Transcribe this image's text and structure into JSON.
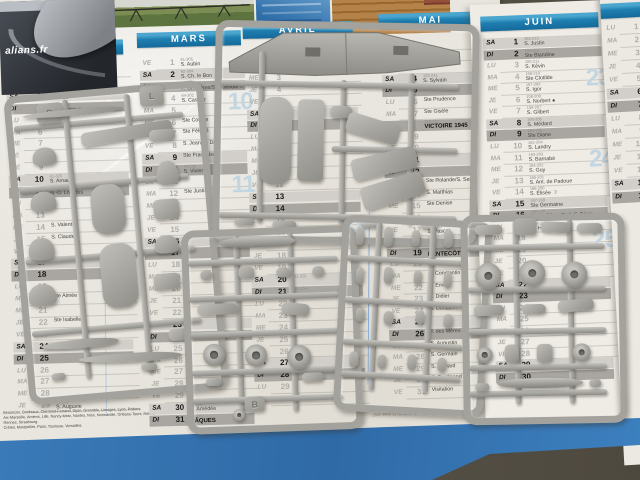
{
  "magazine": {
    "text": "alians.fr"
  },
  "calendar": {
    "day_abbrevs": [
      "LU",
      "MA",
      "ME",
      "JE",
      "VE",
      "SA",
      "DI"
    ],
    "months": [
      {
        "name": "FÉVRIER",
        "start": 3,
        "weeks": [],
        "rows": [
          [
            1,
            "32-334",
            "Ste Ella"
          ],
          [
            2,
            "33-333",
            "Présentation ☾"
          ],
          [
            3,
            "34-332",
            "S. Blaise"
          ],
          [
            4,
            "35-331",
            "Ste Véronique"
          ],
          [
            5,
            "",
            ""
          ],
          [
            6,
            "",
            ""
          ],
          [
            7,
            "",
            ""
          ],
          [
            8,
            "",
            ""
          ],
          [
            9,
            "",
            ""
          ],
          [
            10,
            "41-325",
            "S. Arnaud"
          ],
          [
            11,
            "42-324",
            "N.-D. Lourdes"
          ],
          [
            12,
            "",
            ""
          ],
          [
            13,
            "",
            ""
          ],
          [
            14,
            "",
            "S. Valentin"
          ],
          [
            15,
            "",
            "S. Claude"
          ],
          [
            16,
            "",
            ""
          ],
          [
            17,
            "",
            ""
          ],
          [
            18,
            "",
            ""
          ],
          [
            19,
            "",
            ""
          ],
          [
            20,
            "",
            "Ste Aimée"
          ],
          [
            21,
            "",
            ""
          ],
          [
            22,
            "",
            "Ste Isabelle"
          ],
          [
            23,
            "",
            ""
          ],
          [
            24,
            "",
            ""
          ],
          [
            25,
            "",
            ""
          ],
          [
            26,
            "",
            ""
          ],
          [
            27,
            "",
            ""
          ],
          [
            28,
            "",
            ""
          ],
          [
            29,
            "60-306",
            "S. Auguste"
          ]
        ]
      },
      {
        "name": "MARS",
        "start": 4,
        "weeks": [
          {
            "n": "10",
            "at": 4
          },
          {
            "n": "11",
            "at": 11
          }
        ],
        "rows": [
          [
            1,
            "61-305",
            "S. Aubin"
          ],
          [
            2,
            "62-304",
            "S. Ch. le Bon"
          ],
          [
            3,
            "63-303",
            "F. Gr.-Mères/S. Guénolé ☾"
          ],
          [
            4,
            "64-302",
            "S. Casimir"
          ],
          [
            5,
            "",
            ""
          ],
          [
            6,
            "",
            "Ste Colette"
          ],
          [
            7,
            "",
            "Ste Félicité"
          ],
          [
            8,
            "",
            "S. Jean de Dieu"
          ],
          [
            9,
            "",
            "Ste Françoise"
          ],
          [
            10,
            "70-296",
            "S. Vivien"
          ],
          [
            11,
            "",
            ""
          ],
          [
            12,
            "",
            "Ste Justine"
          ],
          [
            13,
            "",
            ""
          ],
          [
            14,
            "",
            ""
          ],
          [
            15,
            "",
            ""
          ],
          [
            16,
            "",
            ""
          ],
          [
            17,
            "",
            ""
          ],
          [
            18,
            "",
            ""
          ],
          [
            19,
            "",
            ""
          ],
          [
            20,
            "",
            ""
          ],
          [
            21,
            "",
            ""
          ],
          [
            22,
            "",
            ""
          ],
          [
            23,
            "",
            ""
          ],
          [
            24,
            "",
            ""
          ],
          [
            25,
            "",
            ""
          ],
          [
            26,
            "",
            ""
          ],
          [
            27,
            "",
            ""
          ],
          [
            28,
            "",
            ""
          ],
          [
            29,
            "",
            ""
          ],
          [
            30,
            "90-276",
            "S. Amédée"
          ],
          [
            31,
            "91-275",
            "PÂQUES",
            "h"
          ]
        ]
      },
      {
        "name": "AVRIL",
        "start": 0,
        "weeks": [
          {
            "n": "16",
            "at": 15
          }
        ],
        "rows": [
          [
            1,
            "",
            ""
          ],
          [
            2,
            "",
            ""
          ],
          [
            3,
            "",
            ""
          ],
          [
            4,
            "",
            ""
          ],
          [
            5,
            "",
            ""
          ],
          [
            6,
            "",
            ""
          ],
          [
            7,
            "",
            ""
          ],
          [
            8,
            "",
            ""
          ],
          [
            9,
            "",
            ""
          ],
          [
            10,
            "",
            ""
          ],
          [
            11,
            "",
            ""
          ],
          [
            12,
            "",
            ""
          ],
          [
            13,
            "",
            ""
          ],
          [
            14,
            "",
            ""
          ],
          [
            15,
            "",
            ""
          ],
          [
            16,
            "",
            ""
          ],
          [
            17,
            "",
            ""
          ],
          [
            18,
            "",
            ""
          ],
          [
            19,
            "",
            ""
          ],
          [
            20,
            "111-255",
            ""
          ],
          [
            21,
            "112-254",
            ""
          ],
          [
            22,
            "",
            ""
          ],
          [
            23,
            "",
            ""
          ],
          [
            24,
            "",
            ""
          ],
          [
            25,
            "",
            ""
          ],
          [
            26,
            "",
            ""
          ],
          [
            27,
            "",
            ""
          ],
          [
            28,
            "",
            ""
          ],
          [
            29,
            "",
            ""
          ],
          [
            30,
            "",
            ""
          ]
        ]
      },
      {
        "name": "MAI",
        "start": 2,
        "weeks": [
          {
            "n": "19",
            "at": 6
          },
          {
            "n": "20",
            "at": 13
          }
        ],
        "rows": [
          [
            1,
            "",
            ""
          ],
          [
            2,
            "",
            ""
          ],
          [
            3,
            "",
            ""
          ],
          [
            4,
            "125-241",
            "S. Sylvain"
          ],
          [
            5,
            "126-240",
            ""
          ],
          [
            6,
            "",
            "Ste Prudence"
          ],
          [
            7,
            "",
            "Ste Gisèle"
          ],
          [
            8,
            "129-237",
            "VICTOIRE 1945",
            "h"
          ],
          [
            9,
            "",
            ""
          ],
          [
            10,
            "",
            ""
          ],
          [
            11,
            "",
            ""
          ],
          [
            12,
            "",
            ""
          ],
          [
            13,
            "",
            "Ste Rolande/S. Servais"
          ],
          [
            14,
            "",
            "S. Matthias"
          ],
          [
            15,
            "",
            "Ste Denise"
          ],
          [
            16,
            "",
            ""
          ],
          [
            17,
            "138-228",
            "S. Pascal"
          ],
          [
            18,
            "139-227",
            ""
          ],
          [
            19,
            "140-226",
            "PENTECÔTE",
            "h"
          ],
          [
            20,
            "",
            ""
          ],
          [
            21,
            "",
            "S. Constantin"
          ],
          [
            22,
            "",
            "S. Émile"
          ],
          [
            23,
            "",
            "S. Didier"
          ],
          [
            24,
            "",
            "S. Donatien"
          ],
          [
            25,
            "",
            ""
          ],
          [
            26,
            "",
            "F. des Mères"
          ],
          [
            27,
            "",
            "S. Augustin"
          ],
          [
            28,
            "",
            "S. Germain"
          ],
          [
            29,
            "",
            "S. Aymard"
          ],
          [
            30,
            "",
            "S. Ferdinand"
          ],
          [
            31,
            "",
            "Visitation"
          ]
        ]
      },
      {
        "name": "JUIN",
        "start": 5,
        "weeks": [
          {
            "n": "23",
            "at": 4
          },
          {
            "n": "24",
            "at": 11
          },
          {
            "n": "25",
            "at": 18
          }
        ],
        "rows": [
          [
            1,
            "153-213",
            "S. Justin"
          ],
          [
            2,
            "154-212",
            "Ste Blandine"
          ],
          [
            3,
            "155-211",
            "S. Kévin"
          ],
          [
            4,
            "156-210",
            "Ste Clotilde"
          ],
          [
            5,
            "157-209",
            "S. Igor"
          ],
          [
            6,
            "158-208",
            "S. Norbert ●"
          ],
          [
            7,
            "159-207",
            "S. Gilbert"
          ],
          [
            8,
            "160-206",
            "S. Médard"
          ],
          [
            9,
            "161-205",
            "Ste Diane"
          ],
          [
            10,
            "162-204",
            "S. Landry"
          ],
          [
            11,
            "163-203",
            "S. Barnabé"
          ],
          [
            12,
            "164-202",
            "S. Guy"
          ],
          [
            13,
            "165-201",
            "S. Ant. de Padoue"
          ],
          [
            14,
            "166-200",
            "S. Élisée ☽"
          ],
          [
            15,
            "167-199",
            "Ste Germaine"
          ],
          [
            16,
            "168-198",
            "F. des Pères/S. J.-F. Régis"
          ],
          [
            17,
            "169-197",
            "S. Hervé"
          ],
          [
            18,
            "",
            ""
          ],
          [
            19,
            "",
            ""
          ],
          [
            20,
            "",
            ""
          ],
          [
            21,
            "",
            ""
          ],
          [
            22,
            "",
            ""
          ],
          [
            23,
            "",
            ""
          ],
          [
            24,
            "",
            ""
          ],
          [
            25,
            "",
            ""
          ],
          [
            26,
            "",
            ""
          ],
          [
            27,
            "",
            ""
          ],
          [
            28,
            "",
            ""
          ],
          [
            29,
            "",
            ""
          ],
          [
            30,
            "",
            ""
          ]
        ]
      },
      {
        "name": "",
        "start": 0,
        "weeks": [],
        "rows": [
          [
            1,
            "",
            ""
          ],
          [
            2,
            "",
            ""
          ],
          [
            3,
            "",
            ""
          ],
          [
            4,
            "",
            ""
          ],
          [
            5,
            "",
            ""
          ],
          [
            6,
            "",
            ""
          ],
          [
            7,
            "",
            ""
          ],
          [
            8,
            "",
            ""
          ],
          [
            9,
            "",
            ""
          ],
          [
            10,
            "",
            ""
          ],
          [
            11,
            "",
            ""
          ],
          [
            12,
            "",
            ""
          ],
          [
            13,
            "",
            ""
          ],
          [
            14,
            "",
            ""
          ]
        ]
      }
    ],
    "zones": [
      "Besançon, Bordeaux, Clermont-Ferrand, Dijon, Grenoble, Limoges, Lyon, Poitiers.",
      "Aix-Marseille, Amiens, Lille, Nancy-Metz, Nantes, Nice, Normandie, Orléans-Tours, Reims, Rennes, Strasbourg.",
      "Créteil, Montpellier, Paris, Toulouse, Versailles."
    ],
    "footer": "Reproduction interdite d'après la loi du 11 mars 1957"
  },
  "sprues": {
    "pad_b": "B",
    "pad_d": "D",
    "pad_l": "L",
    "pad_w": ""
  },
  "colors": {
    "header_blue": "#1f7fb0",
    "band_di": "#a9a6a1",
    "band_sa": "#d2cfca",
    "week_blue": "#c2d6e2",
    "plastic_gray": "#a3a29d",
    "mat_blue": "#3b7cba"
  }
}
